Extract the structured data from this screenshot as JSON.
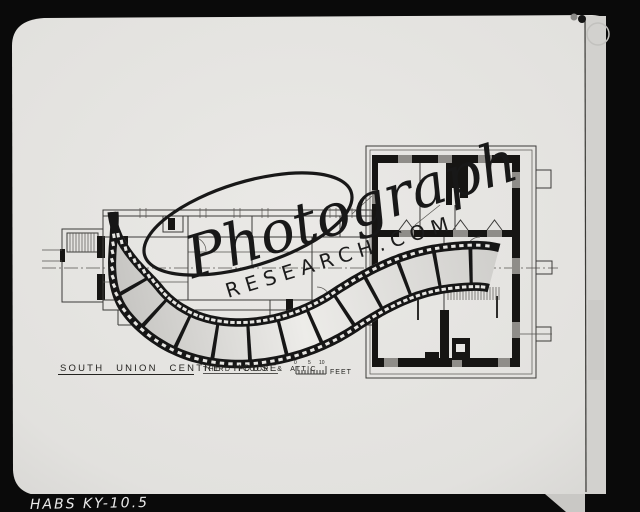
{
  "photo": {
    "archive_label": "HABS KY-10.5",
    "watermark": {
      "script": "Photograph",
      "domain": "RESEARCH.COM"
    },
    "plan": {
      "title": "SOUTH UNION CENTRE HOUSE",
      "subtitle": "THIRD FLOOR & ATTIC",
      "scale": {
        "tick0": "0",
        "tick5": "5",
        "tick10": "10",
        "unit": "FEET"
      }
    }
  },
  "colors": {
    "frame_black": "#0a0a0a",
    "paper": "#e7e6e3",
    "ink": "#1a1a1a",
    "film_band": "#161616",
    "sleeve_strip": "#d2d1ce",
    "label_text": "#e9e9e9"
  }
}
